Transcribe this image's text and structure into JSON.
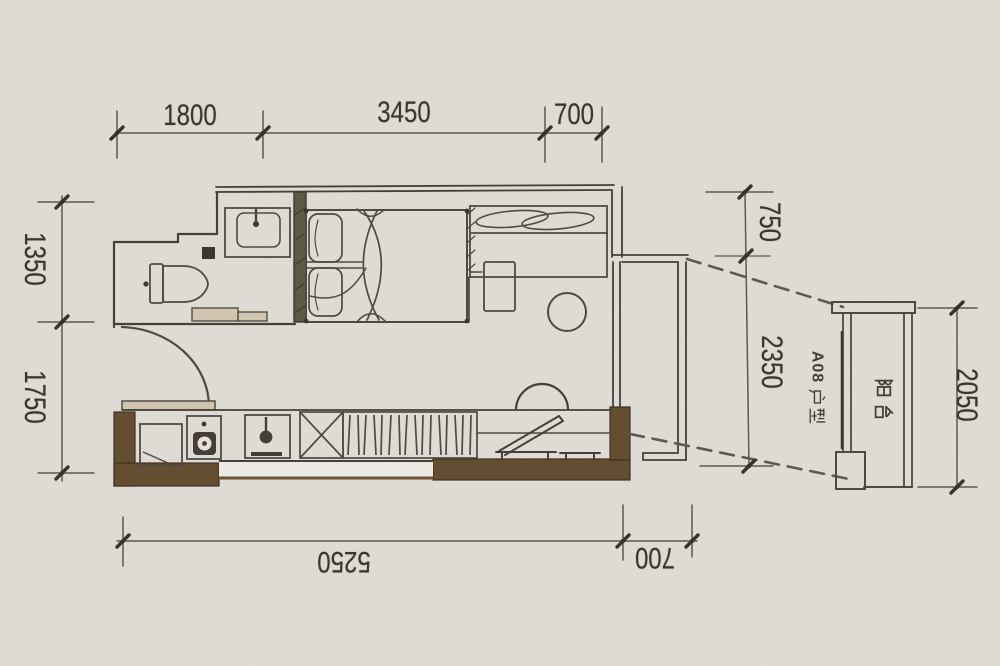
{
  "title": "apartment floor plan (scanned drawing)",
  "labels": {
    "unit": "A08户型",
    "unit_prefix": "A08",
    "unit_suffix_hanzi": [
      "户",
      "型"
    ],
    "balcony": "阳台"
  },
  "dimensions": {
    "top": [
      "1800",
      "3450",
      "700"
    ],
    "left": [
      "1350",
      "1750"
    ],
    "right": [
      "750",
      "2350"
    ],
    "balcony_right": "2050",
    "bottom": [
      "5250",
      "700"
    ]
  },
  "rooms_symbols": [
    "toilet",
    "washbasin",
    "bed",
    "wardrobe",
    "nightstand",
    "stool",
    "entry-door",
    "kitchen-counter",
    "fridge",
    "stove",
    "kitchen-sink",
    "storage-hatch",
    "bench",
    "lounge-chair",
    "balcony-detail"
  ],
  "colors": {
    "paper": "#eae7e1",
    "ink": "#3b372f",
    "wall_fill_brown": "#5d4526",
    "counter_tan": "#d3c7ae",
    "dim_line": "#55504a"
  }
}
